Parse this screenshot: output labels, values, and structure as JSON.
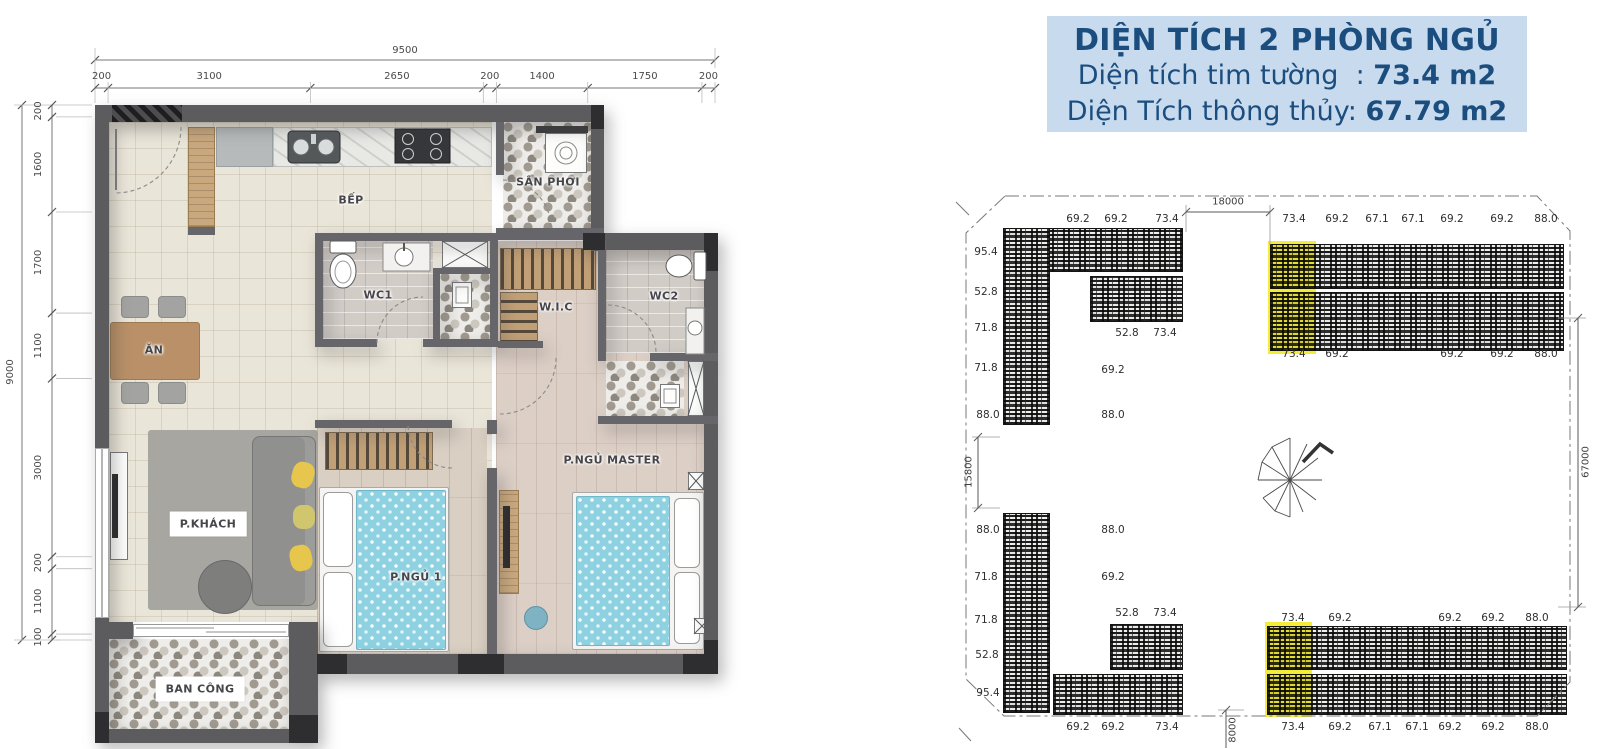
{
  "info_box": {
    "title": "DIỆN TÍCH 2 PHÒNG NGỦ",
    "rows": [
      {
        "label": "Diện tích tim tường  : ",
        "value": "73.4 m2"
      },
      {
        "label": "Diện Tích thông thủy: ",
        "value": "67.79 m2"
      }
    ],
    "bg_color": "#c8daee",
    "text_color": "#1b4e7e"
  },
  "floorplan": {
    "room_labels": [
      {
        "t": "BẾP",
        "x": 351,
        "y": 200
      },
      {
        "t": "SÂN PHƠI",
        "x": 548,
        "y": 182
      },
      {
        "t": "WC1",
        "x": 378,
        "y": 295
      },
      {
        "t": "W.I.C",
        "x": 556,
        "y": 307
      },
      {
        "t": "WC2",
        "x": 664,
        "y": 296
      },
      {
        "t": "ĂN",
        "x": 154,
        "y": 350
      },
      {
        "t": "P.KHÁCH",
        "x": 208,
        "y": 524,
        "chip": true
      },
      {
        "t": "P.NGỦ 1",
        "x": 416,
        "y": 577
      },
      {
        "t": "P.NGỦ MASTER",
        "x": 612,
        "y": 460
      },
      {
        "t": "BAN CÔNG",
        "x": 200,
        "y": 689,
        "chip": true
      }
    ],
    "dim_top": {
      "total": 9500,
      "segments": [
        200,
        3100,
        2650,
        200,
        1400,
        1750,
        200
      ]
    },
    "dim_left": {
      "total": 9000,
      "segments": [
        200,
        1600,
        1700,
        1100,
        3000,
        200,
        1100,
        100
      ]
    }
  },
  "siteplan": {
    "highlight_color": "#f4ec38",
    "highlighted_unit_area": "73.4",
    "dim_labels": [
      {
        "t": "18000",
        "x": 1228,
        "y": 202,
        "rot": false
      },
      {
        "t": "15800",
        "x": 969,
        "y": 472,
        "rot": true
      },
      {
        "t": "8000",
        "x": 1233,
        "y": 730,
        "rot": true
      },
      {
        "t": "67000",
        "x": 1586,
        "y": 462,
        "rot": true
      }
    ],
    "unit_labels": [
      {
        "t": "69.2",
        "x": 1078,
        "y": 219
      },
      {
        "t": "69.2",
        "x": 1116,
        "y": 219
      },
      {
        "t": "73.4",
        "x": 1167,
        "y": 219
      },
      {
        "t": "73.4",
        "x": 1294,
        "y": 219
      },
      {
        "t": "69.2",
        "x": 1337,
        "y": 219
      },
      {
        "t": "67.1",
        "x": 1377,
        "y": 219
      },
      {
        "t": "67.1",
        "x": 1413,
        "y": 219
      },
      {
        "t": "69.2",
        "x": 1452,
        "y": 219
      },
      {
        "t": "69.2",
        "x": 1502,
        "y": 219
      },
      {
        "t": "88.0",
        "x": 1546,
        "y": 219
      },
      {
        "t": "73.4",
        "x": 1294,
        "y": 354
      },
      {
        "t": "69.2",
        "x": 1337,
        "y": 354
      },
      {
        "t": "69.2",
        "x": 1452,
        "y": 354
      },
      {
        "t": "69.2",
        "x": 1502,
        "y": 354
      },
      {
        "t": "88.0",
        "x": 1546,
        "y": 354
      },
      {
        "t": "52.8",
        "x": 1127,
        "y": 333
      },
      {
        "t": "73.4",
        "x": 1165,
        "y": 333
      },
      {
        "t": "95.4",
        "x": 986,
        "y": 252
      },
      {
        "t": "52.8",
        "x": 986,
        "y": 292
      },
      {
        "t": "71.8",
        "x": 986,
        "y": 328
      },
      {
        "t": "71.8",
        "x": 986,
        "y": 368
      },
      {
        "t": "88.0",
        "x": 988,
        "y": 415
      },
      {
        "t": "69.2",
        "x": 1113,
        "y": 370
      },
      {
        "t": "88.0",
        "x": 1113,
        "y": 415
      },
      {
        "t": "88.0",
        "x": 1113,
        "y": 530
      },
      {
        "t": "69.2",
        "x": 1113,
        "y": 577
      },
      {
        "t": "88.0",
        "x": 988,
        "y": 530
      },
      {
        "t": "71.8",
        "x": 986,
        "y": 577
      },
      {
        "t": "71.8",
        "x": 986,
        "y": 620
      },
      {
        "t": "52.8",
        "x": 987,
        "y": 655
      },
      {
        "t": "95.4",
        "x": 988,
        "y": 693
      },
      {
        "t": "52.8",
        "x": 1127,
        "y": 613
      },
      {
        "t": "73.4",
        "x": 1165,
        "y": 613
      },
      {
        "t": "73.4",
        "x": 1293,
        "y": 618
      },
      {
        "t": "69.2",
        "x": 1340,
        "y": 618
      },
      {
        "t": "69.2",
        "x": 1450,
        "y": 618
      },
      {
        "t": "69.2",
        "x": 1493,
        "y": 618
      },
      {
        "t": "88.0",
        "x": 1537,
        "y": 618
      },
      {
        "t": "69.2",
        "x": 1078,
        "y": 727
      },
      {
        "t": "69.2",
        "x": 1113,
        "y": 727
      },
      {
        "t": "73.4",
        "x": 1167,
        "y": 727
      },
      {
        "t": "73.4",
        "x": 1293,
        "y": 727
      },
      {
        "t": "69.2",
        "x": 1340,
        "y": 727
      },
      {
        "t": "67.1",
        "x": 1380,
        "y": 727
      },
      {
        "t": "67.1",
        "x": 1417,
        "y": 727
      },
      {
        "t": "69.2",
        "x": 1450,
        "y": 727
      },
      {
        "t": "69.2",
        "x": 1493,
        "y": 727
      },
      {
        "t": "88.0",
        "x": 1537,
        "y": 727
      }
    ]
  }
}
